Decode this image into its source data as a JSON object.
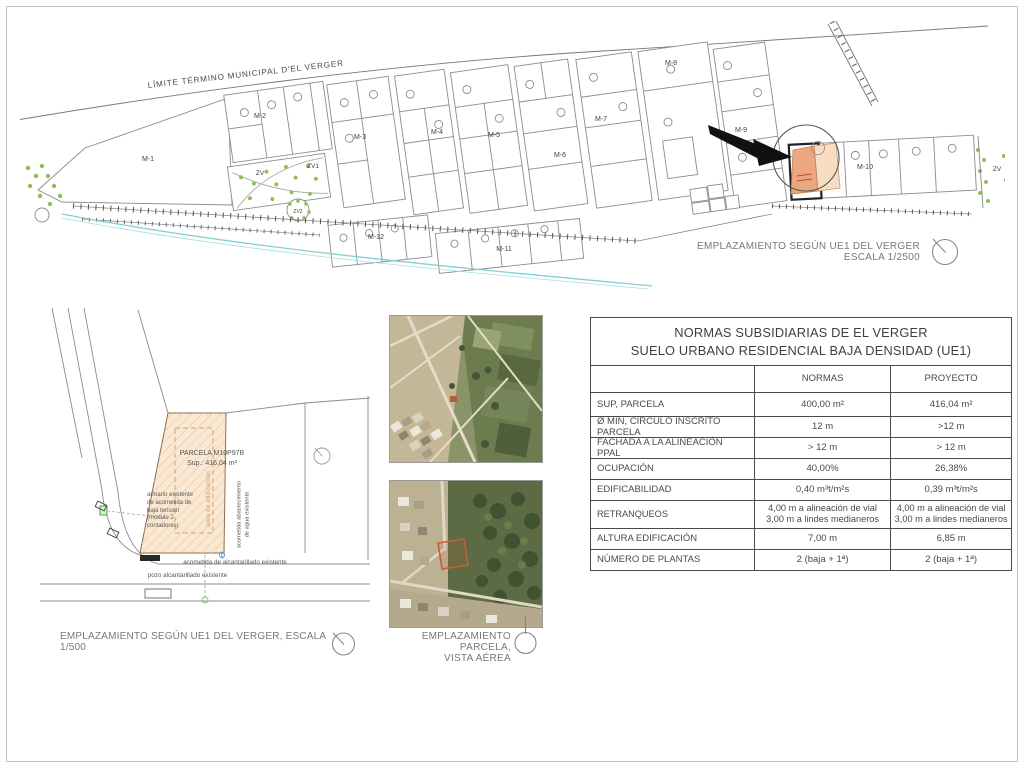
{
  "page": {
    "border_color": "#c2c2c2"
  },
  "colors": {
    "highlight_parcel": "#eba87f",
    "highlight_parcel_light": "#f8ddc4",
    "green_zone_dot": "#90bf55",
    "stream": "#86cfcf",
    "detail_parcel_fill": "#f9e8d4",
    "detail_parcel_hatch": "#ecc49a",
    "aerial_red_outline": "#cf5a33"
  },
  "site_plan": {
    "boundary_label": "LÍMITE TÉRMINO MUNICIPAL D'EL VERGER",
    "blocks": [
      "M-1",
      "M-2",
      "M-3",
      "M-4",
      "M-5",
      "M-6",
      "M-7",
      "M-8",
      "M-9",
      "M-10",
      "M-11",
      "M-12"
    ],
    "green_zones": [
      "ZV",
      "ZV1",
      "ZV2",
      "ZV"
    ],
    "caption_line1": "EMPLAZAMIENTO SEGÚN UE1 DEL VERGER",
    "caption_line2": "ESCALA 1/2500"
  },
  "detail_plan": {
    "parcel_title": "PARCELA M10P97B",
    "parcel_area": "Sup.: 416,04 m²",
    "label_armario": "armario existente\nde acometida de\nbaja tensión\n(módulo 2\ncontadores)",
    "label_edificacion": "área de edificación",
    "label_agua": "acometida abastecimiento\nde agua existente",
    "label_alcantarillado": "acometida de alcantarillado existente",
    "label_pozo": "pozo alcantarillado existente",
    "caption": "EMPLAZAMIENTO SEGÚN  UE1 DEL VERGER, ESCALA 1/500"
  },
  "aerial": {
    "caption_line1": "EMPLAZAMIENTO PARCELA,",
    "caption_line2": "VISTA AÉREA"
  },
  "table": {
    "title_line1": "NORMAS SUBSIDIARIAS DE EL VERGER",
    "title_line2": "SUELO URBANO RESIDENCIAL BAJA DENSIDAD (UE1)",
    "col_normas": "NORMAS",
    "col_proyecto": "PROYECTO",
    "rows": [
      {
        "label": "SUP, PARCELA",
        "normas": "400,00 m²",
        "proyecto": "416,04 m²"
      },
      {
        "label": "Ø MÍN, CÍRCULO  INSCRITO PARCELA",
        "normas": "12 m",
        "proyecto": ">12 m"
      },
      {
        "label": "FACHADA A LA ALINEACIÓN PPAL",
        "normas": "> 12 m",
        "proyecto": "> 12 m"
      },
      {
        "label": "OCUPACIÓN",
        "normas": "40,00%",
        "proyecto": "26,38%"
      },
      {
        "label": "EDIFICABILIDAD",
        "normas": "0,40 m³t/m²s",
        "proyecto": "0,39 m³t/m²s"
      },
      {
        "label": "RETRANQUEOS",
        "normas": "4,00 m a alineación de vial\n3,00 m a lindes medianeros",
        "proyecto": "4,00 m a alineación de vial\n3,00 m a lindes medianeros"
      },
      {
        "label": "ALTURA EDIFICACIÓN",
        "normas": "7,00 m",
        "proyecto": "6,85 m"
      },
      {
        "label": "NÚMERO DE PLANTAS",
        "normas": "2 (baja + 1ª)",
        "proyecto": "2 (baja + 1ª)"
      }
    ]
  }
}
